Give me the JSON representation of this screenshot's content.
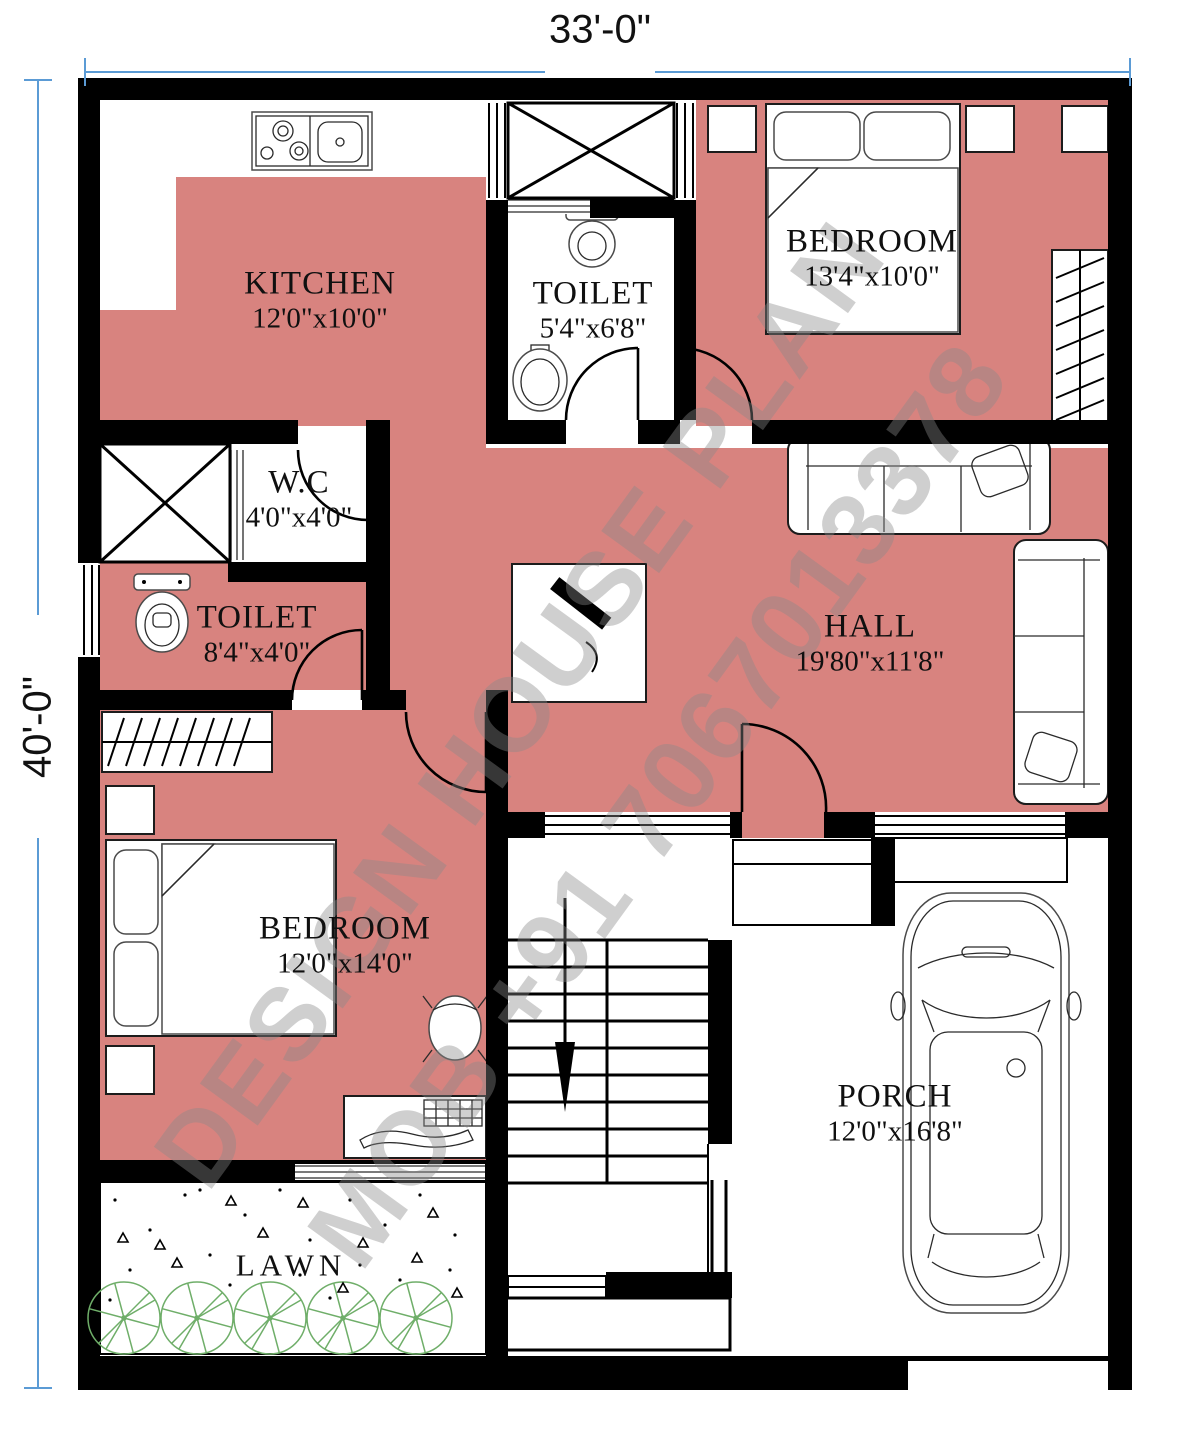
{
  "dimensions": {
    "top": "33'-0\"",
    "left": "40'-0\""
  },
  "rooms": {
    "kitchen": {
      "name": "KITCHEN",
      "size": "12'0\"x10'0\""
    },
    "toilet_top": {
      "name": "TOILET",
      "size": "5'4\"x6'8\""
    },
    "bedroom_top": {
      "name": "BEDROOM",
      "size": "13'4\"x10'0\""
    },
    "wc": {
      "name": "W.C",
      "size": "4'0\"x4'0\""
    },
    "toilet_left": {
      "name": "TOILET",
      "size": "8'4\"x4'0\""
    },
    "hall": {
      "name": "HALL",
      "size": "19'80\"x11'8\""
    },
    "bedroom_bottom": {
      "name": "BEDROOM",
      "size": "12'0\"x14'0\""
    },
    "porch": {
      "name": "PORCH",
      "size": "12'0\"x16'8\""
    },
    "lawn": {
      "name": "LAWN"
    }
  },
  "watermark": {
    "line1": "DESIGN HOUSE PLAN",
    "line2": "MOB +91 7067013378"
  },
  "colors": {
    "floor": "#d8837f",
    "wall": "#000000",
    "dim_line": "#5b9bd5",
    "tree": "#6fae69",
    "watermark": "#8a8a8a"
  }
}
